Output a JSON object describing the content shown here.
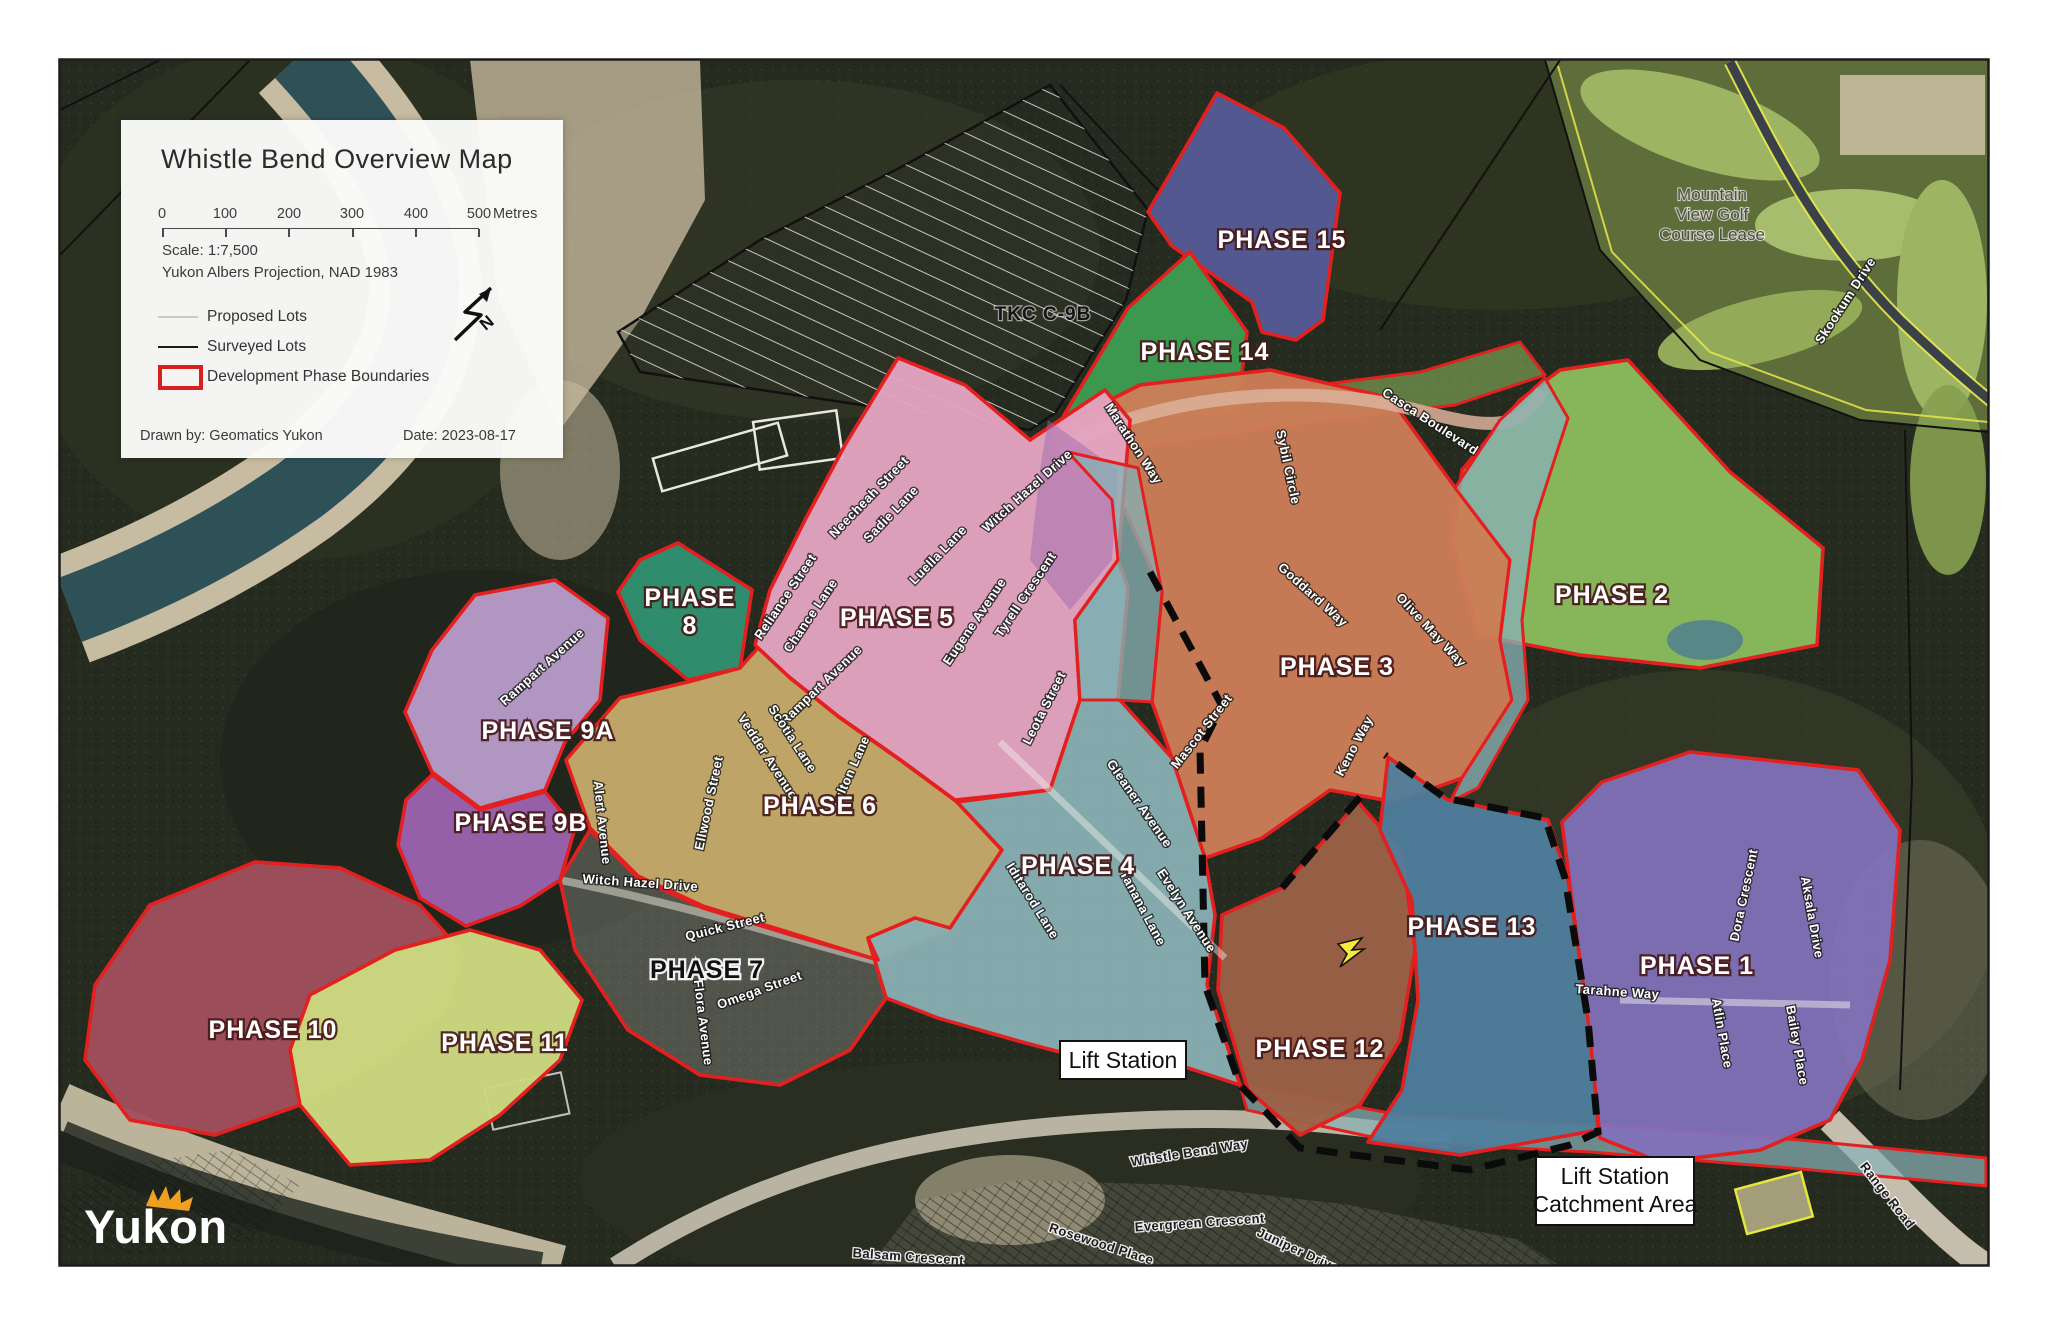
{
  "legend": {
    "title": "Whistle Bend Overview Map",
    "scale_ticks": [
      "0",
      "100",
      "200",
      "300",
      "400",
      "500"
    ],
    "scale_unit": "Metres",
    "scale_text": "Scale: 1:7,500",
    "projection_text": "Yukon Albers Projection, NAD 1983",
    "items": [
      {
        "label": "Proposed Lots",
        "line_color": "#c9c9c9"
      },
      {
        "label": "Surveyed Lots",
        "line_color": "#1a1a1a"
      },
      {
        "label": "Development Phase Boundaries",
        "box_color": "#d8201f"
      }
    ],
    "drawn_by": "Drawn by: Geomatics Yukon",
    "date": "Date: 2023-08-17",
    "north_label": "N"
  },
  "logo": {
    "text": "Yukon",
    "sun_color": "#f0a01e"
  },
  "boundary_colors": {
    "phase_boundary": "#e3201f",
    "catchment_dash": "#0b0b0b"
  },
  "phases": [
    {
      "id": "1",
      "label": "PHASE 1",
      "color": "#8272bb"
    },
    {
      "id": "2",
      "label": "PHASE 2",
      "color": "#8fc060"
    },
    {
      "id": "3",
      "label": "PHASE 3",
      "color": "#cd7e57"
    },
    {
      "id": "4",
      "label": "PHASE 4",
      "color": "#88b0b4"
    },
    {
      "id": "5",
      "label": "PHASE 5",
      "color": "#e3a4c0"
    },
    {
      "id": "6",
      "label": "PHASE 6",
      "color": "#c4aa6a"
    },
    {
      "id": "7",
      "label": "PHASE 7",
      "color": ""
    },
    {
      "id": "8",
      "label": "PHASE 8",
      "color": "#2f9170",
      "label_lines": [
        "PHASE",
        "8"
      ]
    },
    {
      "id": "9A",
      "label": "PHASE 9A",
      "color": "#b79cc8"
    },
    {
      "id": "9B",
      "label": "PHASE 9B",
      "color": "#9a63ad"
    },
    {
      "id": "10",
      "label": "PHASE 10",
      "color": "#a24f5e"
    },
    {
      "id": "11",
      "label": "PHASE 11",
      "color": "#ccd87f"
    },
    {
      "id": "12",
      "label": "PHASE 12",
      "color": "#9c6246"
    },
    {
      "id": "13",
      "label": "PHASE 13",
      "color": "#4f7f9e"
    },
    {
      "id": "14",
      "label": "PHASE 14",
      "color": "#3f9e52"
    },
    {
      "id": "15",
      "label": "PHASE 15",
      "color": "#555a96"
    }
  ],
  "areas": {
    "tkc": {
      "label": "TKC C-9B"
    },
    "golf": {
      "lines": [
        "Mountain",
        "View Golf",
        "Course Lease"
      ]
    }
  },
  "callouts": {
    "lift_station": {
      "label": "Lift Station"
    },
    "catchment": {
      "lines": [
        "Lift Station",
        "Catchment Area"
      ]
    }
  },
  "streets": [
    {
      "name": "Casca Boulevard"
    },
    {
      "name": "Marathon Way"
    },
    {
      "name": "Sybil Circle"
    },
    {
      "name": "Goddard Way"
    },
    {
      "name": "Olive May Way"
    },
    {
      "name": "Keno Way"
    },
    {
      "name": "Mascot Street"
    },
    {
      "name": "Leota Street"
    },
    {
      "name": "Gleaner Avenue"
    },
    {
      "name": "Evelyn Avenue"
    },
    {
      "name": "Tanana Lane"
    },
    {
      "name": "Iditarod Lane"
    },
    {
      "name": "Witch Hazel Drive"
    },
    {
      "name": "Witch Hazel Drive"
    },
    {
      "name": "Neecheah Street"
    },
    {
      "name": "Sadie Lane"
    },
    {
      "name": "Luella Lane"
    },
    {
      "name": "Reliance Street"
    },
    {
      "name": "Chance Lane"
    },
    {
      "name": "Eugene Avenue"
    },
    {
      "name": "Tyrell Crescent"
    },
    {
      "name": "Rampart Avenue"
    },
    {
      "name": "Rampart Avenue"
    },
    {
      "name": "Vedder Avenue"
    },
    {
      "name": "Scotia Lane"
    },
    {
      "name": "Ellwood Street"
    },
    {
      "name": "Fulton Lane"
    },
    {
      "name": "Quick Street"
    },
    {
      "name": "Omega Street"
    },
    {
      "name": "Flora Avenue"
    },
    {
      "name": "Alert Avenue"
    },
    {
      "name": "Tarahne Way"
    },
    {
      "name": "Dora Crescent"
    },
    {
      "name": "Aksala Drive"
    },
    {
      "name": "Atlin Place"
    },
    {
      "name": "Bailey Place"
    },
    {
      "name": "Whistle Bend Way"
    },
    {
      "name": "Evergreen Crescent"
    },
    {
      "name": "Rosewood Place"
    },
    {
      "name": "Balsam Crescent"
    },
    {
      "name": "Range Road"
    },
    {
      "name": "Skookum Drive"
    },
    {
      "name": "Juniper Drive"
    }
  ]
}
